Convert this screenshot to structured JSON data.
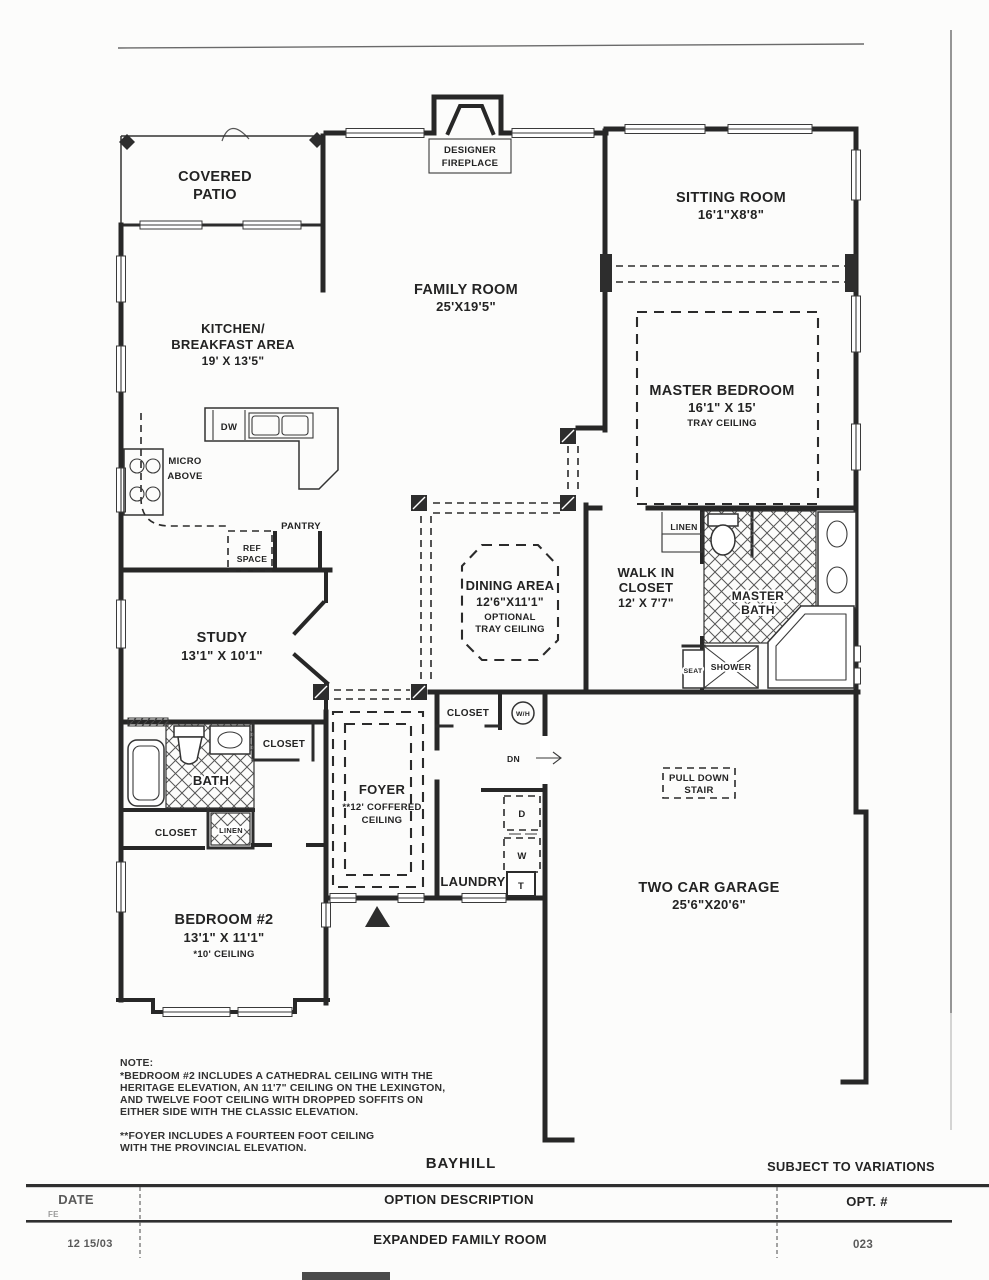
{
  "page": {
    "background": "#fcfcfb",
    "ink": "#272727",
    "border_gray": "#6a6a6a"
  },
  "rooms": {
    "covered_patio": [
      "COVERED",
      "PATIO"
    ],
    "family_room": [
      "FAMILY ROOM",
      "25'X19'5\""
    ],
    "sitting_room": [
      "SITTING ROOM",
      "16'1\"X8'8\""
    ],
    "kitchen": [
      "KITCHEN/",
      "BREAKFAST AREA",
      "19' X 13'5\""
    ],
    "master_bedroom": [
      "MASTER BEDROOM",
      "16'1\" X 15'",
      "TRAY CEILING"
    ],
    "dining_area": [
      "DINING AREA",
      "12'6\"X11'1\"",
      "OPTIONAL",
      "TRAY CEILING"
    ],
    "walk_in_closet": [
      "WALK IN",
      "CLOSET",
      "12' X 7'7\""
    ],
    "master_bath": [
      "MASTER",
      "BATH"
    ],
    "study": [
      "STUDY",
      "13'1\" X 10'1\""
    ],
    "hall_bath": "BATH",
    "foyer": [
      "FOYER",
      "**12' COFFERED",
      "CEILING"
    ],
    "laundry": "LAUNDRY",
    "garage": [
      "TWO CAR GARAGE",
      "25'6\"X20'6\""
    ],
    "bedroom_2": [
      "BEDROOM #2",
      "13'1\" X 11'1\"",
      "*10' CEILING"
    ]
  },
  "features": {
    "designer_fireplace": [
      "DESIGNER",
      "FIREPLACE"
    ],
    "pull_down_stair": [
      "PULL DOWN",
      "STAIR"
    ],
    "micro_above": [
      "MICRO",
      "ABOVE"
    ],
    "dishwasher": "DW",
    "ref_space": [
      "REF",
      "SPACE"
    ],
    "pantry": "PANTRY",
    "linen_master": "LINEN",
    "linen_hall": "LINEN",
    "closet_hall": "CLOSET",
    "closet_bedroom2": "CLOSET",
    "closet_entry": "CLOSET",
    "shower": "SHOWER",
    "seat": "SEAT",
    "water_heater": "W/H",
    "stair_down": "DN",
    "dryer": "D",
    "washer": "W",
    "laundry_tub": "T"
  },
  "note": {
    "heading": "NOTE:",
    "para1": [
      "*BEDROOM #2 INCLUDES A CATHEDRAL CEILING WITH THE",
      "HERITAGE ELEVATION, AN 11'7\" CEILING ON THE LEXINGTON,",
      "AND TWELVE FOOT CEILING WITH DROPPED SOFFITS ON",
      "EITHER SIDE WITH THE CLASSIC ELEVATION."
    ],
    "para2": [
      "**FOYER INCLUDES A FOURTEEN FOOT CEILING",
      "WITH THE PROVINCIAL ELEVATION."
    ]
  },
  "title_block": {
    "plan_name": "BAYHILL",
    "disclaimer": "SUBJECT TO VARIATIONS",
    "margin_mark": "FE",
    "headers": {
      "date": "DATE",
      "option": "OPTION DESCRIPTION",
      "opt_no": "OPT. #"
    },
    "row": {
      "date": "12 15/03",
      "option": "EXPANDED FAMILY ROOM",
      "opt_no": "023"
    }
  }
}
